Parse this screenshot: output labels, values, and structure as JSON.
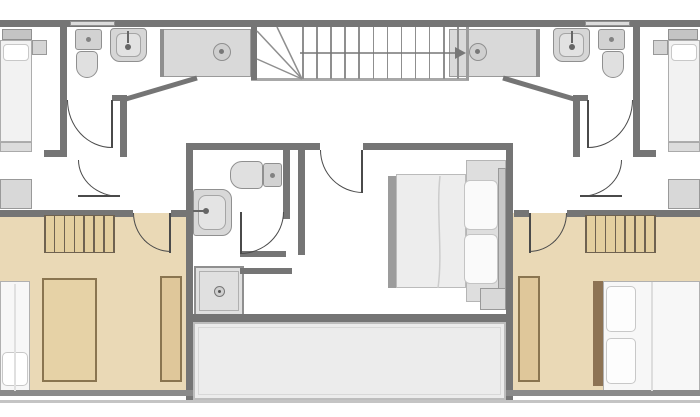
{
  "palette": {
    "wall": "#757575",
    "wall_light": "#9c9c9c",
    "beige": "#ead9b6",
    "hatch_bg": "#e4cf9f",
    "hatch_line": "#6f6250",
    "brown": "#8a7550",
    "wardrobe": "#dfc79a",
    "fixture": "#d6d6d6",
    "fixture_edge": "#8f8f8f",
    "terrace": "#ececec",
    "door_arc": "#4a4a4a",
    "bed_white": "#f7f7f7"
  },
  "canvas": {
    "width": 700,
    "height": 417
  },
  "shapes": [
    {
      "name": "bedroom-left-floor",
      "x": 0,
      "y": 213,
      "w": 186,
      "h": 179,
      "fill": "#ead9b6"
    },
    {
      "name": "bedroom-right-floor",
      "x": 513,
      "y": 213,
      "w": 187,
      "h": 179,
      "fill": "#ead9b6"
    },
    {
      "name": "terrace-floor",
      "x": 193,
      "y": 322,
      "w": 313,
      "h": 78,
      "fill": "#ececec",
      "stroke": "#bdbdbd",
      "sw": 2
    },
    {
      "name": "terrace-inner-line",
      "x": 198,
      "y": 327,
      "w": 303,
      "h": 68,
      "stroke": "#d8d8d8",
      "sw": 1
    },
    {
      "name": "rug-left-bedroom",
      "x": 42,
      "y": 278,
      "w": 55,
      "h": 104,
      "fill": "#e6d2a6",
      "stroke": "#8a7550",
      "sw": 2
    },
    {
      "name": "bed-left-bedroom-mattress",
      "x": 0,
      "y": 281,
      "w": 30,
      "h": 111,
      "fill": "#f7f7f7",
      "stroke": "#b0b0b0",
      "sw": 1
    },
    {
      "name": "bed-left-bedroom-pillow",
      "x": 2,
      "y": 352,
      "w": 26,
      "h": 34,
      "fill": "#ffffff",
      "stroke": "#c8c8c8",
      "sw": 1,
      "r": "5px"
    },
    {
      "name": "wardrobe-left-bedroom",
      "x": 160,
      "y": 276,
      "w": 22,
      "h": 106,
      "fill": "#dfc79a",
      "stroke": "#8a7550",
      "sw": 2
    },
    {
      "name": "bed-right-bedroom-headboard",
      "x": 593,
      "y": 281,
      "w": 10,
      "h": 105,
      "fill": "#8d7354"
    },
    {
      "name": "bed-right-bedroom-mattress",
      "x": 603,
      "y": 281,
      "w": 97,
      "h": 111,
      "fill": "#f7f7f7",
      "stroke": "#b0b0b0",
      "sw": 1
    },
    {
      "name": "bed-right-bedroom-pillow-1",
      "x": 606,
      "y": 286,
      "w": 30,
      "h": 46,
      "fill": "#fdfdfd",
      "stroke": "#c8c8c8",
      "sw": 1,
      "r": "5px"
    },
    {
      "name": "bed-right-bedroom-pillow-2",
      "x": 606,
      "y": 338,
      "w": 30,
      "h": 46,
      "fill": "#fdfdfd",
      "stroke": "#c8c8c8",
      "sw": 1,
      "r": "5px"
    },
    {
      "name": "wardrobe-right-bedroom",
      "x": 518,
      "y": 276,
      "w": 22,
      "h": 106,
      "fill": "#dfc79a",
      "stroke": "#8a7550",
      "sw": 2
    },
    {
      "name": "bed-niche-center",
      "x": 466,
      "y": 160,
      "w": 40,
      "h": 142,
      "fill": "#dedede",
      "stroke": "#b5b5b5",
      "sw": 1
    },
    {
      "name": "bed-center-footboard",
      "x": 388,
      "y": 176,
      "w": 8,
      "h": 112,
      "fill": "#9c9c9c"
    },
    {
      "name": "bed-center-mattress",
      "x": 396,
      "y": 174,
      "w": 70,
      "h": 114,
      "fill": "#ededed",
      "stroke": "#bbbbbb",
      "sw": 1
    },
    {
      "name": "bed-center-pillow-1",
      "x": 464,
      "y": 180,
      "w": 34,
      "h": 50,
      "fill": "#fafafa",
      "stroke": "#c4c4c4",
      "sw": 1,
      "r": "6px"
    },
    {
      "name": "bed-center-pillow-2",
      "x": 464,
      "y": 234,
      "w": 34,
      "h": 50,
      "fill": "#fafafa",
      "stroke": "#c4c4c4",
      "sw": 1,
      "r": "6px"
    },
    {
      "name": "bed-center-headboard",
      "x": 498,
      "y": 168,
      "w": 8,
      "h": 128,
      "fill": "#c6c6c6",
      "stroke": "#999999",
      "sw": 1
    },
    {
      "name": "nightstand-center",
      "x": 480,
      "y": 288,
      "w": 26,
      "h": 22,
      "fill": "#d8d8d8",
      "stroke": "#999999",
      "sw": 1
    },
    {
      "name": "bed-top-left-headboard",
      "x": 2,
      "y": 29,
      "w": 30,
      "h": 11,
      "fill": "#c4c4c4",
      "stroke": "#909090",
      "sw": 1
    },
    {
      "name": "bed-top-left-mattress",
      "x": 0,
      "y": 40,
      "w": 32,
      "h": 102,
      "fill": "#f2f2f2",
      "stroke": "#adadad",
      "sw": 1
    },
    {
      "name": "bed-top-left-pillow",
      "x": 3,
      "y": 44,
      "w": 26,
      "h": 17,
      "fill": "#ffffff",
      "stroke": "#c8c8c8",
      "sw": 1,
      "r": "4px"
    },
    {
      "name": "nightstand-top-left",
      "x": 32,
      "y": 40,
      "w": 15,
      "h": 15,
      "fill": "#d5d5d5",
      "stroke": "#999999",
      "sw": 1
    },
    {
      "name": "bench-top-left",
      "x": 0,
      "y": 142,
      "w": 32,
      "h": 10,
      "fill": "#dcdcdc",
      "stroke": "#aaaaaa",
      "sw": 1
    },
    {
      "name": "dresser-top-left",
      "x": 0,
      "y": 179,
      "w": 32,
      "h": 30,
      "fill": "#d8d8d8",
      "stroke": "#999999",
      "sw": 1
    },
    {
      "name": "bed-top-right-headboard",
      "x": 668,
      "y": 29,
      "w": 30,
      "h": 11,
      "fill": "#c4c4c4",
      "stroke": "#909090",
      "sw": 1
    },
    {
      "name": "bed-top-right-mattress",
      "x": 668,
      "y": 40,
      "w": 32,
      "h": 102,
      "fill": "#f2f2f2",
      "stroke": "#adadad",
      "sw": 1
    },
    {
      "name": "bed-top-right-pillow",
      "x": 671,
      "y": 44,
      "w": 26,
      "h": 17,
      "fill": "#ffffff",
      "stroke": "#c8c8c8",
      "sw": 1,
      "r": "4px"
    },
    {
      "name": "nightstand-top-right",
      "x": 653,
      "y": 40,
      "w": 15,
      "h": 15,
      "fill": "#d5d5d5",
      "stroke": "#999999",
      "sw": 1
    },
    {
      "name": "bench-top-right",
      "x": 668,
      "y": 142,
      "w": 32,
      "h": 10,
      "fill": "#dcdcdc",
      "stroke": "#aaaaaa",
      "sw": 1
    },
    {
      "name": "dresser-top-right",
      "x": 668,
      "y": 179,
      "w": 32,
      "h": 30,
      "fill": "#d8d8d8",
      "stroke": "#999999",
      "sw": 1
    },
    {
      "name": "counter-left-bathroom",
      "x": 163,
      "y": 29,
      "w": 88,
      "h": 48,
      "fill": "#d9d9d9",
      "stroke": "#9a9a9a",
      "sw": 1
    },
    {
      "name": "counter-left-partition",
      "x": 160,
      "y": 29,
      "w": 4,
      "h": 48,
      "fill": "#8f8f8f"
    },
    {
      "name": "basin-left",
      "x": 213,
      "y": 43,
      "w": 18,
      "h": 18,
      "fill": "#cfcfcf",
      "stroke": "#8f8f8f",
      "sw": 1,
      "r": "50%"
    },
    {
      "name": "basin-left-dot",
      "x": 219,
      "y": 49,
      "w": 5,
      "h": 5,
      "fill": "#777777",
      "r": "50%"
    },
    {
      "name": "toilet-left-tank",
      "x": 75,
      "y": 29,
      "w": 27,
      "h": 21,
      "fill": "#d2d2d2",
      "stroke": "#909090",
      "sw": 1,
      "r": "3px"
    },
    {
      "name": "toilet-left-tank-dot",
      "x": 86,
      "y": 37,
      "w": 5,
      "h": 5,
      "fill": "#828282",
      "r": "50%"
    },
    {
      "name": "toilet-left-bowl",
      "x": 76,
      "y": 51,
      "w": 22,
      "h": 27,
      "fill": "#e0e0e0",
      "stroke": "#909090",
      "sw": 1,
      "r": "5px 5px 11px 11px"
    },
    {
      "name": "sink-left",
      "x": 110,
      "y": 28,
      "w": 37,
      "h": 34,
      "fill": "#d6d6d6",
      "stroke": "#909090",
      "sw": 1,
      "r": "4px 4px 10px 10px"
    },
    {
      "name": "sink-left-basin",
      "x": 116,
      "y": 33,
      "w": 25,
      "h": 24,
      "fill": "#e2e2e2",
      "stroke": "#a5a5a5",
      "sw": 1,
      "r": "6px"
    },
    {
      "name": "faucet-left-line",
      "x": 127,
      "y": 31,
      "w": 2,
      "h": 12,
      "fill": "#666666"
    },
    {
      "name": "faucet-left-dot",
      "x": 125,
      "y": 44,
      "w": 6,
      "h": 6,
      "fill": "#666666",
      "r": "50%"
    },
    {
      "name": "counter-right-bathroom",
      "x": 449,
      "y": 29,
      "w": 88,
      "h": 48,
      "fill": "#d9d9d9",
      "stroke": "#9a9a9a",
      "sw": 1
    },
    {
      "name": "counter-right-partition",
      "x": 536,
      "y": 29,
      "w": 4,
      "h": 48,
      "fill": "#8f8f8f"
    },
    {
      "name": "basin-right",
      "x": 469,
      "y": 43,
      "w": 18,
      "h": 18,
      "fill": "#cfcfcf",
      "stroke": "#8f8f8f",
      "sw": 1,
      "r": "50%"
    },
    {
      "name": "basin-right-dot",
      "x": 475,
      "y": 49,
      "w": 5,
      "h": 5,
      "fill": "#777777",
      "r": "50%"
    },
    {
      "name": "toilet-right-tank",
      "x": 598,
      "y": 29,
      "w": 27,
      "h": 21,
      "fill": "#d2d2d2",
      "stroke": "#909090",
      "sw": 1,
      "r": "3px"
    },
    {
      "name": "toilet-right-tank-dot",
      "x": 609,
      "y": 37,
      "w": 5,
      "h": 5,
      "fill": "#828282",
      "r": "50%"
    },
    {
      "name": "toilet-right-bowl",
      "x": 602,
      "y": 51,
      "w": 22,
      "h": 27,
      "fill": "#e0e0e0",
      "stroke": "#909090",
      "sw": 1,
      "r": "5px 5px 11px 11px"
    },
    {
      "name": "sink-right",
      "x": 553,
      "y": 28,
      "w": 37,
      "h": 34,
      "fill": "#d6d6d6",
      "stroke": "#909090",
      "sw": 1,
      "r": "4px 4px 10px 10px"
    },
    {
      "name": "sink-right-basin",
      "x": 559,
      "y": 33,
      "w": 25,
      "h": 24,
      "fill": "#e2e2e2",
      "stroke": "#a5a5a5",
      "sw": 1,
      "r": "6px"
    },
    {
      "name": "faucet-right-line",
      "x": 571,
      "y": 31,
      "w": 2,
      "h": 12,
      "fill": "#666666"
    },
    {
      "name": "faucet-right-dot",
      "x": 569,
      "y": 44,
      "w": 6,
      "h": 6,
      "fill": "#666666",
      "r": "50%"
    },
    {
      "name": "toilet-center-bowl",
      "x": 230,
      "y": 161,
      "w": 33,
      "h": 28,
      "fill": "#e0e0e0",
      "stroke": "#909090",
      "sw": 1,
      "r": "12px 5px 5px 12px"
    },
    {
      "name": "toilet-center-tank",
      "x": 263,
      "y": 163,
      "w": 19,
      "h": 24,
      "fill": "#d2d2d2",
      "stroke": "#909090",
      "sw": 1,
      "r": "3px"
    },
    {
      "name": "toilet-center-tank-dot",
      "x": 270,
      "y": 173,
      "w": 5,
      "h": 5,
      "fill": "#828282",
      "r": "50%"
    },
    {
      "name": "sink-center",
      "x": 193,
      "y": 189,
      "w": 39,
      "h": 47,
      "fill": "#d8d8d8",
      "stroke": "#909090",
      "sw": 1,
      "r": "3px 10px 10px 3px"
    },
    {
      "name": "sink-center-basin",
      "x": 198,
      "y": 195,
      "w": 28,
      "h": 35,
      "fill": "#e4e4e4",
      "stroke": "#a5a5a5",
      "sw": 1,
      "r": "8px"
    },
    {
      "name": "faucet-center-line",
      "x": 193,
      "y": 210,
      "w": 12,
      "h": 2,
      "fill": "#666666"
    },
    {
      "name": "faucet-center-dot",
      "x": 203,
      "y": 208,
      "w": 6,
      "h": 6,
      "fill": "#666666",
      "r": "50%"
    },
    {
      "name": "shower-center",
      "x": 194,
      "y": 266,
      "w": 50,
      "h": 50,
      "fill": "#e0e0e0",
      "stroke": "#8f8f8f",
      "sw": 2
    },
    {
      "name": "shower-center-inner",
      "x": 199,
      "y": 271,
      "w": 40,
      "h": 40,
      "stroke": "#b0b0b0",
      "sw": 1
    },
    {
      "name": "shower-center-drain",
      "x": 214,
      "y": 286,
      "w": 11,
      "h": 11,
      "fill": "#cfcfcf",
      "stroke": "#777777",
      "sw": 1,
      "r": "50%"
    },
    {
      "name": "shower-center-drain-dot",
      "x": 218,
      "y": 290,
      "w": 3,
      "h": 3,
      "fill": "#555555",
      "r": "50%"
    },
    {
      "name": "stair-bottom-line",
      "x": 251,
      "y": 78,
      "w": 218,
      "h": 3,
      "fill": "#a8a8a8"
    },
    {
      "name": "stair-left-wall",
      "x": 251,
      "y": 27,
      "w": 6,
      "h": 53,
      "fill": "#757575"
    },
    {
      "name": "stair-right-wall",
      "x": 466,
      "y": 27,
      "w": 3,
      "h": 53,
      "fill": "#9c9c9c"
    },
    {
      "name": "wall-top",
      "x": 0,
      "y": 20,
      "w": 700,
      "h": 7,
      "fill": "#757575"
    },
    {
      "name": "window-top-left",
      "x": 70,
      "y": 21,
      "w": 45,
      "h": 5,
      "fill": "#dcdcdc",
      "stroke": "#909090",
      "sw": 1
    },
    {
      "name": "window-top-right",
      "x": 585,
      "y": 21,
      "w": 45,
      "h": 5,
      "fill": "#dcdcdc",
      "stroke": "#909090",
      "sw": 1
    },
    {
      "name": "wall-left-bedroom-divider",
      "x": 60,
      "y": 27,
      "w": 7,
      "h": 125,
      "fill": "#757575"
    },
    {
      "name": "wall-left-corridor-stub",
      "x": 44,
      "y": 150,
      "w": 23,
      "h": 7,
      "fill": "#757575"
    },
    {
      "name": "wall-left-hall-vertical",
      "x": 120,
      "y": 95,
      "w": 7,
      "h": 62,
      "fill": "#757575"
    },
    {
      "name": "wall-left-hall-corner",
      "x": 112,
      "y": 95,
      "w": 15,
      "h": 6,
      "fill": "#757575"
    },
    {
      "name": "wall-right-bedroom-divider",
      "x": 633,
      "y": 27,
      "w": 7,
      "h": 125,
      "fill": "#757575"
    },
    {
      "name": "wall-right-corridor-stub",
      "x": 633,
      "y": 150,
      "w": 23,
      "h": 7,
      "fill": "#757575"
    },
    {
      "name": "wall-right-hall-vertical",
      "x": 573,
      "y": 95,
      "w": 7,
      "h": 62,
      "fill": "#757575"
    },
    {
      "name": "wall-right-hall-corner",
      "x": 573,
      "y": 95,
      "w": 15,
      "h": 6,
      "fill": "#757575"
    },
    {
      "name": "wall-center-left-vertical",
      "x": 186,
      "y": 143,
      "w": 7,
      "h": 259,
      "fill": "#757575"
    },
    {
      "name": "wall-center-top-left",
      "x": 186,
      "y": 143,
      "w": 134,
      "h": 7,
      "fill": "#757575"
    },
    {
      "name": "wall-center-top-right",
      "x": 363,
      "y": 143,
      "w": 143,
      "h": 7,
      "fill": "#757575"
    },
    {
      "name": "wall-center-right-vertical",
      "x": 506,
      "y": 143,
      "w": 7,
      "h": 259,
      "fill": "#757575"
    },
    {
      "name": "wall-bathroom-right-upper",
      "x": 283,
      "y": 143,
      "w": 7,
      "h": 76,
      "fill": "#757575"
    },
    {
      "name": "wall-bathroom-stub-1",
      "x": 240,
      "y": 251,
      "w": 46,
      "h": 6,
      "fill": "#757575"
    },
    {
      "name": "wall-bathroom-stub-2",
      "x": 240,
      "y": 268,
      "w": 52,
      "h": 6,
      "fill": "#757575"
    },
    {
      "name": "wall-bedroom-center-left",
      "x": 298,
      "y": 143,
      "w": 7,
      "h": 112,
      "fill": "#757575"
    },
    {
      "name": "wall-bottom-center",
      "x": 186,
      "y": 314,
      "w": 327,
      "h": 8,
      "fill": "#757575"
    },
    {
      "name": "wall-beige-top-left-a",
      "x": 0,
      "y": 210,
      "w": 133,
      "h": 7,
      "fill": "#757575"
    },
    {
      "name": "wall-beige-top-left-b",
      "x": 171,
      "y": 210,
      "w": 15,
      "h": 7,
      "fill": "#757575"
    },
    {
      "name": "wall-beige-top-right-a",
      "x": 514,
      "y": 210,
      "w": 15,
      "h": 7,
      "fill": "#757575"
    },
    {
      "name": "wall-beige-top-right-b",
      "x": 567,
      "y": 210,
      "w": 133,
      "h": 7,
      "fill": "#757575"
    },
    {
      "name": "wall-beige-bottom-left",
      "x": 0,
      "y": 390,
      "w": 193,
      "h": 6,
      "fill": "#8a8a8a"
    },
    {
      "name": "wall-beige-bottom-right",
      "x": 506,
      "y": 390,
      "w": 194,
      "h": 6,
      "fill": "#8a8a8a"
    },
    {
      "name": "line-bottom-edge",
      "x": 0,
      "y": 400,
      "w": 700,
      "h": 3,
      "fill": "#c4c4c4"
    }
  ],
  "closets": [
    {
      "name": "closet-hatch-left",
      "x": 44,
      "y": 215,
      "w": 71,
      "h": 38,
      "lines": 8,
      "bg": "#e4cf9f",
      "line_color": "#6f6250"
    },
    {
      "name": "closet-hatch-right",
      "x": 585,
      "y": 215,
      "w": 71,
      "h": 38,
      "lines": 8,
      "bg": "#e4cf9f",
      "line_color": "#6f6250"
    }
  ],
  "stairs": {
    "name": "staircase",
    "treads": {
      "x0": 302,
      "dx": 14.1,
      "count": 12,
      "y": 27,
      "h": 52,
      "color": "#8f8f8f"
    }
  },
  "doors": [
    {
      "name": "door-left-hall",
      "x": 67,
      "y": 100,
      "w": 45,
      "h": 48,
      "corner": "bl",
      "leaf": {
        "x": 111,
        "y": 100,
        "w": 2,
        "h": 48
      }
    },
    {
      "name": "door-left-corridor",
      "x": 78,
      "y": 160,
      "w": 42,
      "h": 37,
      "corner": "bl",
      "leaf": {
        "x": 78,
        "y": 195,
        "w": 42,
        "h": 2
      }
    },
    {
      "name": "door-bedroom-left",
      "x": 133,
      "y": 213,
      "w": 38,
      "h": 39,
      "corner": "bl",
      "leaf": {
        "x": 169,
        "y": 213,
        "w": 2,
        "h": 40
      }
    },
    {
      "name": "door-bedroom-center",
      "x": 320,
      "y": 150,
      "w": 43,
      "h": 43,
      "corner": "bl",
      "leaf": {
        "x": 361,
        "y": 150,
        "w": 2,
        "h": 43
      }
    },
    {
      "name": "door-bathroom-center",
      "x": 240,
      "y": 212,
      "w": 44,
      "h": 42,
      "corner": "br",
      "leaf": {
        "x": 240,
        "y": 212,
        "w": 2,
        "h": 42
      }
    },
    {
      "name": "door-right-hall",
      "x": 588,
      "y": 100,
      "w": 45,
      "h": 48,
      "corner": "br",
      "leaf": {
        "x": 587,
        "y": 100,
        "w": 2,
        "h": 48
      }
    },
    {
      "name": "door-right-corridor",
      "x": 580,
      "y": 160,
      "w": 42,
      "h": 37,
      "corner": "br",
      "leaf": {
        "x": 580,
        "y": 195,
        "w": 42,
        "h": 2
      }
    },
    {
      "name": "door-bedroom-right",
      "x": 529,
      "y": 213,
      "w": 38,
      "h": 39,
      "corner": "br",
      "leaf": {
        "x": 529,
        "y": 213,
        "w": 2,
        "h": 40
      }
    }
  ],
  "svg": {
    "lines": [
      {
        "name": "wall-diagonal-left",
        "x1": 126,
        "y1": 99,
        "x2": 197,
        "y2": 78,
        "c": "#757575",
        "w": 5
      },
      {
        "name": "wall-diagonal-right",
        "x1": 503,
        "y1": 78,
        "x2": 574,
        "y2": 99,
        "c": "#757575",
        "w": 5
      },
      {
        "name": "stair-winder-1",
        "x1": 302,
        "y1": 79,
        "x2": 257,
        "y2": 31,
        "c": "#8f8f8f",
        "w": 1.5
      },
      {
        "name": "stair-winder-2",
        "x1": 302,
        "y1": 79,
        "x2": 277,
        "y2": 27,
        "c": "#8f8f8f",
        "w": 1.5
      },
      {
        "name": "stair-winder-3",
        "x1": 302,
        "y1": 79,
        "x2": 257,
        "y2": 59,
        "c": "#8f8f8f",
        "w": 1.5
      },
      {
        "name": "stair-direction-line",
        "x1": 300,
        "y1": 53,
        "x2": 455,
        "y2": 53,
        "c": "#777777",
        "w": 1.5
      }
    ],
    "paths": [
      {
        "name": "bed-center-crease",
        "d": "M440,176 C436,212 443,252 438,288",
        "c": "#cccccc",
        "w": 1.5
      },
      {
        "name": "bed-right-crease",
        "d": "M652,282 L652,391",
        "c": "#dddddd",
        "w": 2
      },
      {
        "name": "bed-left-crease",
        "d": "M15,284 L15,391",
        "c": "#e0e0e0",
        "w": 2
      }
    ],
    "polygons": [
      {
        "name": "stair-direction-arrowhead",
        "points": "455,47 466,53 455,59",
        "c": "#777777"
      }
    ]
  }
}
